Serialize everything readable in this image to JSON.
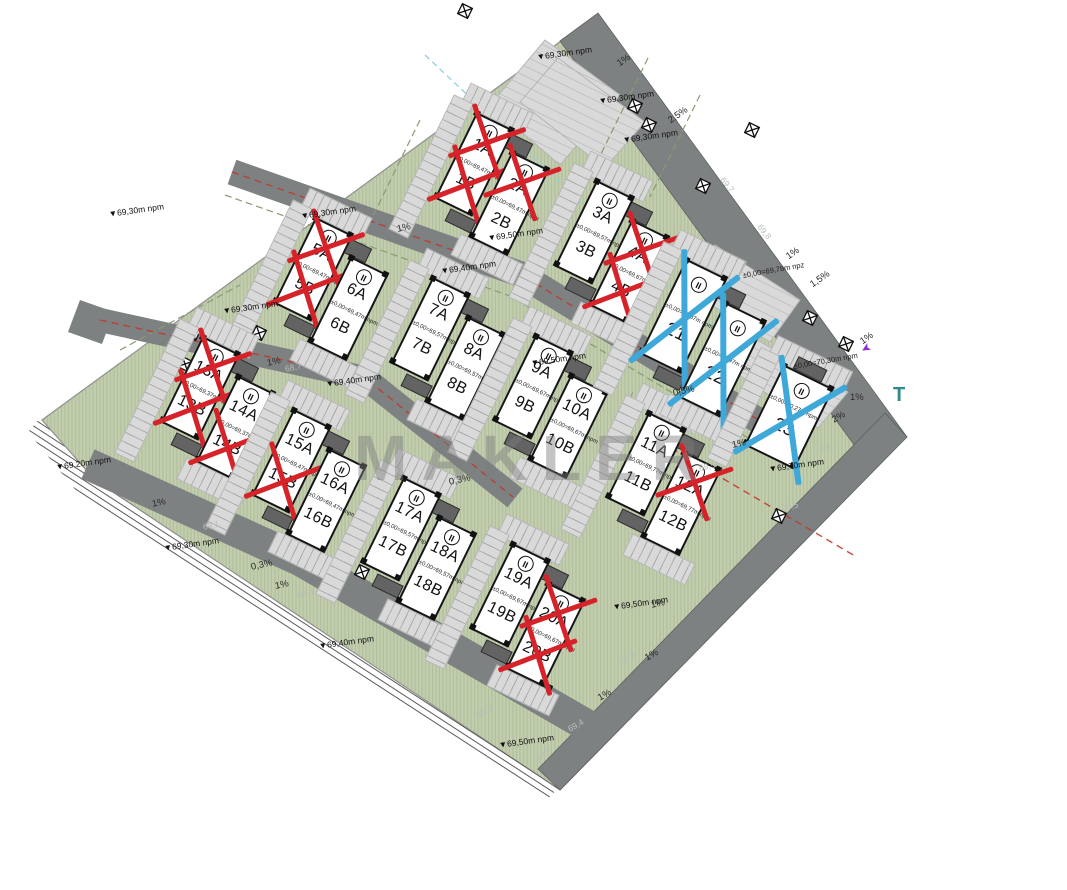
{
  "watermark": "MAKLER",
  "storey_symbol": "II",
  "colors": {
    "site_green": "#c2cdae",
    "road_gray": "#7d8182",
    "paved_gray": "#d9d9d9",
    "building_border": "#151515",
    "sold_cross_red": "#d6232a",
    "reserved_cross_blue": "#3ea8d9",
    "red_utility_line": "#c0392b",
    "cyan_utility_line": "#8fd2df",
    "watermark_gray": "#7d7d7d",
    "teal_letter": "#2e8b8b",
    "purple_mark": "#8d2bd6"
  },
  "buildings": [
    {
      "id": "b1",
      "cx": 492,
      "cy": 184,
      "type": "duo",
      "halves": [
        {
          "num": "1",
          "a": "1A",
          "b": "1B",
          "elev": "±0,00=69,47m npm",
          "ax": "red",
          "bx": "red"
        },
        {
          "num": "2",
          "a": "2A",
          "b": "2B",
          "elev": "±0,00=69,47m npm",
          "ax": "red",
          "bx": null
        }
      ]
    },
    {
      "id": "b2",
      "cx": 612,
      "cy": 252,
      "type": "duo",
      "halves": [
        {
          "num": "3",
          "a": "3A",
          "b": "3B",
          "elev": "±0,00=69,57m npm",
          "ax": null,
          "bx": null
        },
        {
          "num": "4",
          "a": "4A",
          "b": "4B",
          "elev": "±0,00=69,67m npm",
          "ax": "red",
          "bx": "red"
        }
      ]
    },
    {
      "id": "b3",
      "cx": 331,
      "cy": 289,
      "type": "duo",
      "halves": [
        {
          "num": "5",
          "a": "5A",
          "b": "5B",
          "elev": "±0,00=69,47m npm",
          "ax": "red",
          "bx": "red"
        },
        {
          "num": "6",
          "a": "6A",
          "b": "6B",
          "elev": "±0,00=69,47m npm",
          "ax": null,
          "bx": null
        }
      ]
    },
    {
      "id": "b4",
      "cx": 448,
      "cy": 349,
      "type": "duo",
      "halves": [
        {
          "num": "7",
          "a": "7A",
          "b": "7B",
          "elev": "±0,00=69,57m npm",
          "ax": null,
          "bx": null
        },
        {
          "num": "8",
          "a": "8A",
          "b": "8B",
          "elev": "±0,00=69,57m npm",
          "ax": null,
          "bx": null
        }
      ]
    },
    {
      "id": "b5",
      "cx": 551,
      "cy": 407,
      "type": "duo",
      "halves": [
        {
          "num": "9",
          "a": "9A",
          "b": "9B",
          "elev": "±0,00=69,67m npm",
          "ax": null,
          "bx": null
        },
        {
          "num": "10",
          "a": "10A",
          "b": "10B",
          "elev": "±0,00=69,67m npm",
          "ax": null,
          "bx": null
        }
      ]
    },
    {
      "id": "b6",
      "cx": 664,
      "cy": 484,
      "type": "duo",
      "halves": [
        {
          "num": "11",
          "a": "11A",
          "b": "11B",
          "elev": "±0,00=69,77m npm",
          "ax": null,
          "bx": null
        },
        {
          "num": "12",
          "a": "12A",
          "b": "12B",
          "elev": "±0,00=69,77m npm",
          "ax": "red",
          "bx": null
        }
      ]
    },
    {
      "id": "b7",
      "cx": 218,
      "cy": 408,
      "type": "duo",
      "halves": [
        {
          "num": "13",
          "a": "13A",
          "b": "13B",
          "elev": "±0,00=69,37m npm",
          "ax": "red",
          "bx": "red"
        },
        {
          "num": "14",
          "a": "14A",
          "b": "14B",
          "elev": "±0,00=69,37m npm",
          "ax": null,
          "bx": "red"
        }
      ]
    },
    {
      "id": "b8",
      "cx": 309,
      "cy": 481,
      "type": "duo",
      "halves": [
        {
          "num": "15",
          "a": "15A",
          "b": "15B",
          "elev": "±0,00=69,47m npm",
          "ax": null,
          "bx": "red"
        },
        {
          "num": "16",
          "a": "16A",
          "b": "16B",
          "elev": "±0,00=69,47m npm",
          "ax": null,
          "bx": null
        }
      ]
    },
    {
      "id": "b9",
      "cx": 419,
      "cy": 549,
      "type": "duo",
      "halves": [
        {
          "num": "17",
          "a": "17A",
          "b": "17B",
          "elev": "±0,00=69,57m npm",
          "ax": null,
          "bx": null
        },
        {
          "num": "18",
          "a": "18A",
          "b": "18B",
          "elev": "±0,00=69,57m npm",
          "ax": null,
          "bx": null
        }
      ]
    },
    {
      "id": "b10",
      "cx": 528,
      "cy": 615,
      "type": "duo",
      "halves": [
        {
          "num": "19",
          "a": "19A",
          "b": "19B",
          "elev": "±0,00=69,67m npm",
          "ax": null,
          "bx": null
        },
        {
          "num": "20",
          "a": "20A",
          "b": "20B",
          "elev": "±0,00=69,67m npm",
          "ax": "red",
          "bx": "red"
        }
      ]
    },
    {
      "id": "b11",
      "cx": 703,
      "cy": 338,
      "type": "twin",
      "halves": [
        {
          "label": "21",
          "elev": "±0,00=69,87m npm",
          "x": "blue"
        },
        {
          "label": "22",
          "elev": "±0,00=69,97m npm",
          "x": "blue"
        }
      ]
    },
    {
      "id": "b12",
      "cx": 789,
      "cy": 417,
      "type": "single",
      "halves": [
        {
          "label": "23",
          "elev": "±0,00=70,27m npm",
          "x": "blue"
        }
      ]
    }
  ],
  "annotations": [
    {
      "t": "▼69,30m npm",
      "x": 108,
      "y": 209,
      "r": -8,
      "k": "elevm"
    },
    {
      "t": "▼69,30m npm",
      "x": 222,
      "y": 306,
      "r": -8,
      "k": "elevm"
    },
    {
      "t": "▼69,30m npm",
      "x": 300,
      "y": 211,
      "r": -8,
      "k": "elevm"
    },
    {
      "t": "▼69,30m npm",
      "x": 536,
      "y": 52,
      "r": -8,
      "k": "elevm"
    },
    {
      "t": "▼69,30m npm",
      "x": 598,
      "y": 96,
      "r": -8,
      "k": "elevm"
    },
    {
      "t": "▼69,30m npm",
      "x": 622,
      "y": 135,
      "r": -8,
      "k": "elevm"
    },
    {
      "t": "▼69,50m npm",
      "x": 487,
      "y": 233,
      "r": -8,
      "k": "elevm"
    },
    {
      "t": "▼69,40m npm",
      "x": 440,
      "y": 266,
      "r": -8,
      "k": "elevm"
    },
    {
      "t": "▼69,50m npm",
      "x": 530,
      "y": 358,
      "r": -8,
      "k": "elevm"
    },
    {
      "t": "▼69,30m npm",
      "x": 163,
      "y": 543,
      "r": -8,
      "k": "elevm"
    },
    {
      "t": "▼69,40m npm",
      "x": 318,
      "y": 641,
      "r": -8,
      "k": "elevm"
    },
    {
      "t": "▼69,40m npm",
      "x": 325,
      "y": 379,
      "r": -8,
      "k": "elevm"
    },
    {
      "t": "▼69,50m npm",
      "x": 612,
      "y": 602,
      "r": -8,
      "k": "elevm"
    },
    {
      "t": "▼69,50m npm",
      "x": 498,
      "y": 740,
      "r": -8,
      "k": "elevm"
    },
    {
      "t": "▼69,70m npm",
      "x": 768,
      "y": 464,
      "r": -8,
      "k": "elevm"
    },
    {
      "t": "▼69,20m npm",
      "x": 55,
      "y": 462,
      "r": -8,
      "k": "elevm"
    },
    {
      "t": "1%",
      "x": 615,
      "y": 60,
      "r": -35,
      "k": "slope"
    },
    {
      "t": "2,5%",
      "x": 666,
      "y": 117,
      "r": -35,
      "k": "slope"
    },
    {
      "t": "1,5%",
      "x": 808,
      "y": 281,
      "r": -35,
      "k": "slope"
    },
    {
      "t": "1%",
      "x": 784,
      "y": 253,
      "r": -35,
      "k": "slope"
    },
    {
      "t": "0,5%",
      "x": 672,
      "y": 388,
      "r": -12,
      "k": "slope"
    },
    {
      "t": "1%",
      "x": 396,
      "y": 224,
      "r": -12,
      "k": "slope"
    },
    {
      "t": "1%",
      "x": 266,
      "y": 358,
      "r": -12,
      "k": "slope"
    },
    {
      "t": "0,3%",
      "x": 448,
      "y": 477,
      "r": -12,
      "k": "slope"
    },
    {
      "t": "0,3%",
      "x": 250,
      "y": 562,
      "r": -12,
      "k": "slope"
    },
    {
      "t": "1%",
      "x": 274,
      "y": 581,
      "r": -12,
      "k": "slope"
    },
    {
      "t": "1%",
      "x": 151,
      "y": 499,
      "r": -12,
      "k": "slope"
    },
    {
      "t": "1%",
      "x": 596,
      "y": 694,
      "r": -30,
      "k": "slope"
    },
    {
      "t": "1%",
      "x": 643,
      "y": 654,
      "r": -30,
      "k": "slope"
    },
    {
      "t": "1%",
      "x": 650,
      "y": 600,
      "r": -12,
      "k": "slope"
    },
    {
      "t": "1%",
      "x": 858,
      "y": 338,
      "r": -35,
      "k": "slope"
    },
    {
      "t": "1%",
      "x": 850,
      "y": 392,
      "r": 0,
      "k": "slope"
    },
    {
      "t": "2%",
      "x": 830,
      "y": 416,
      "r": -30,
      "k": "slope"
    },
    {
      "t": "1%",
      "x": 731,
      "y": 440,
      "r": -12,
      "k": "slope"
    },
    {
      "t": "68,7",
      "x": 284,
      "y": 364,
      "r": -12,
      "k": "spot"
    },
    {
      "t": "69,1",
      "x": 202,
      "y": 522,
      "r": -12,
      "k": "spot"
    },
    {
      "t": "69,8",
      "x": 763,
      "y": 222,
      "r": 50,
      "k": "spot"
    },
    {
      "t": "69,7",
      "x": 726,
      "y": 175,
      "r": 50,
      "k": "spot"
    },
    {
      "t": "69,5",
      "x": 698,
      "y": 463,
      "r": -12,
      "k": "spot"
    },
    {
      "t": "69,5",
      "x": 781,
      "y": 503,
      "r": -12,
      "k": "spot"
    },
    {
      "t": "69,7",
      "x": 820,
      "y": 444,
      "r": -12,
      "k": "spot"
    },
    {
      "t": "69,5",
      "x": 618,
      "y": 658,
      "r": -30,
      "k": "spot"
    },
    {
      "t": "69,4",
      "x": 566,
      "y": 725,
      "r": -30,
      "k": "spot"
    },
    {
      "t": "69,3",
      "x": 474,
      "y": 711,
      "r": -30,
      "k": "spot"
    },
    {
      "t": "69,0",
      "x": 296,
      "y": 590,
      "r": -12,
      "k": "spot"
    },
    {
      "t": "69,5",
      "x": 534,
      "y": 754,
      "r": -30,
      "k": "spot"
    },
    {
      "t": "±0,00=69,78m npz",
      "x": 742,
      "y": 271,
      "r": -10,
      "k": "info"
    },
    {
      "t": "±0,00=70,30m npm",
      "x": 793,
      "y": 362,
      "r": -10,
      "k": "info"
    },
    {
      "t": "T",
      "x": 893,
      "y": 384,
      "r": 0,
      "k": "letter"
    },
    {
      "t": "➤",
      "x": 874,
      "y": 352,
      "r": 150,
      "k": "parrow"
    }
  ],
  "survey_markers": [
    [
      465,
      11
    ],
    [
      635,
      106
    ],
    [
      649,
      125
    ],
    [
      703,
      186
    ],
    [
      752,
      130
    ],
    [
      810,
      318
    ],
    [
      846,
      344
    ],
    [
      193,
      333
    ],
    [
      259,
      333
    ],
    [
      296,
      539
    ],
    [
      362,
      572
    ],
    [
      779,
      516
    ],
    [
      431,
      627
    ],
    [
      545,
      689
    ],
    [
      185,
      364
    ]
  ]
}
